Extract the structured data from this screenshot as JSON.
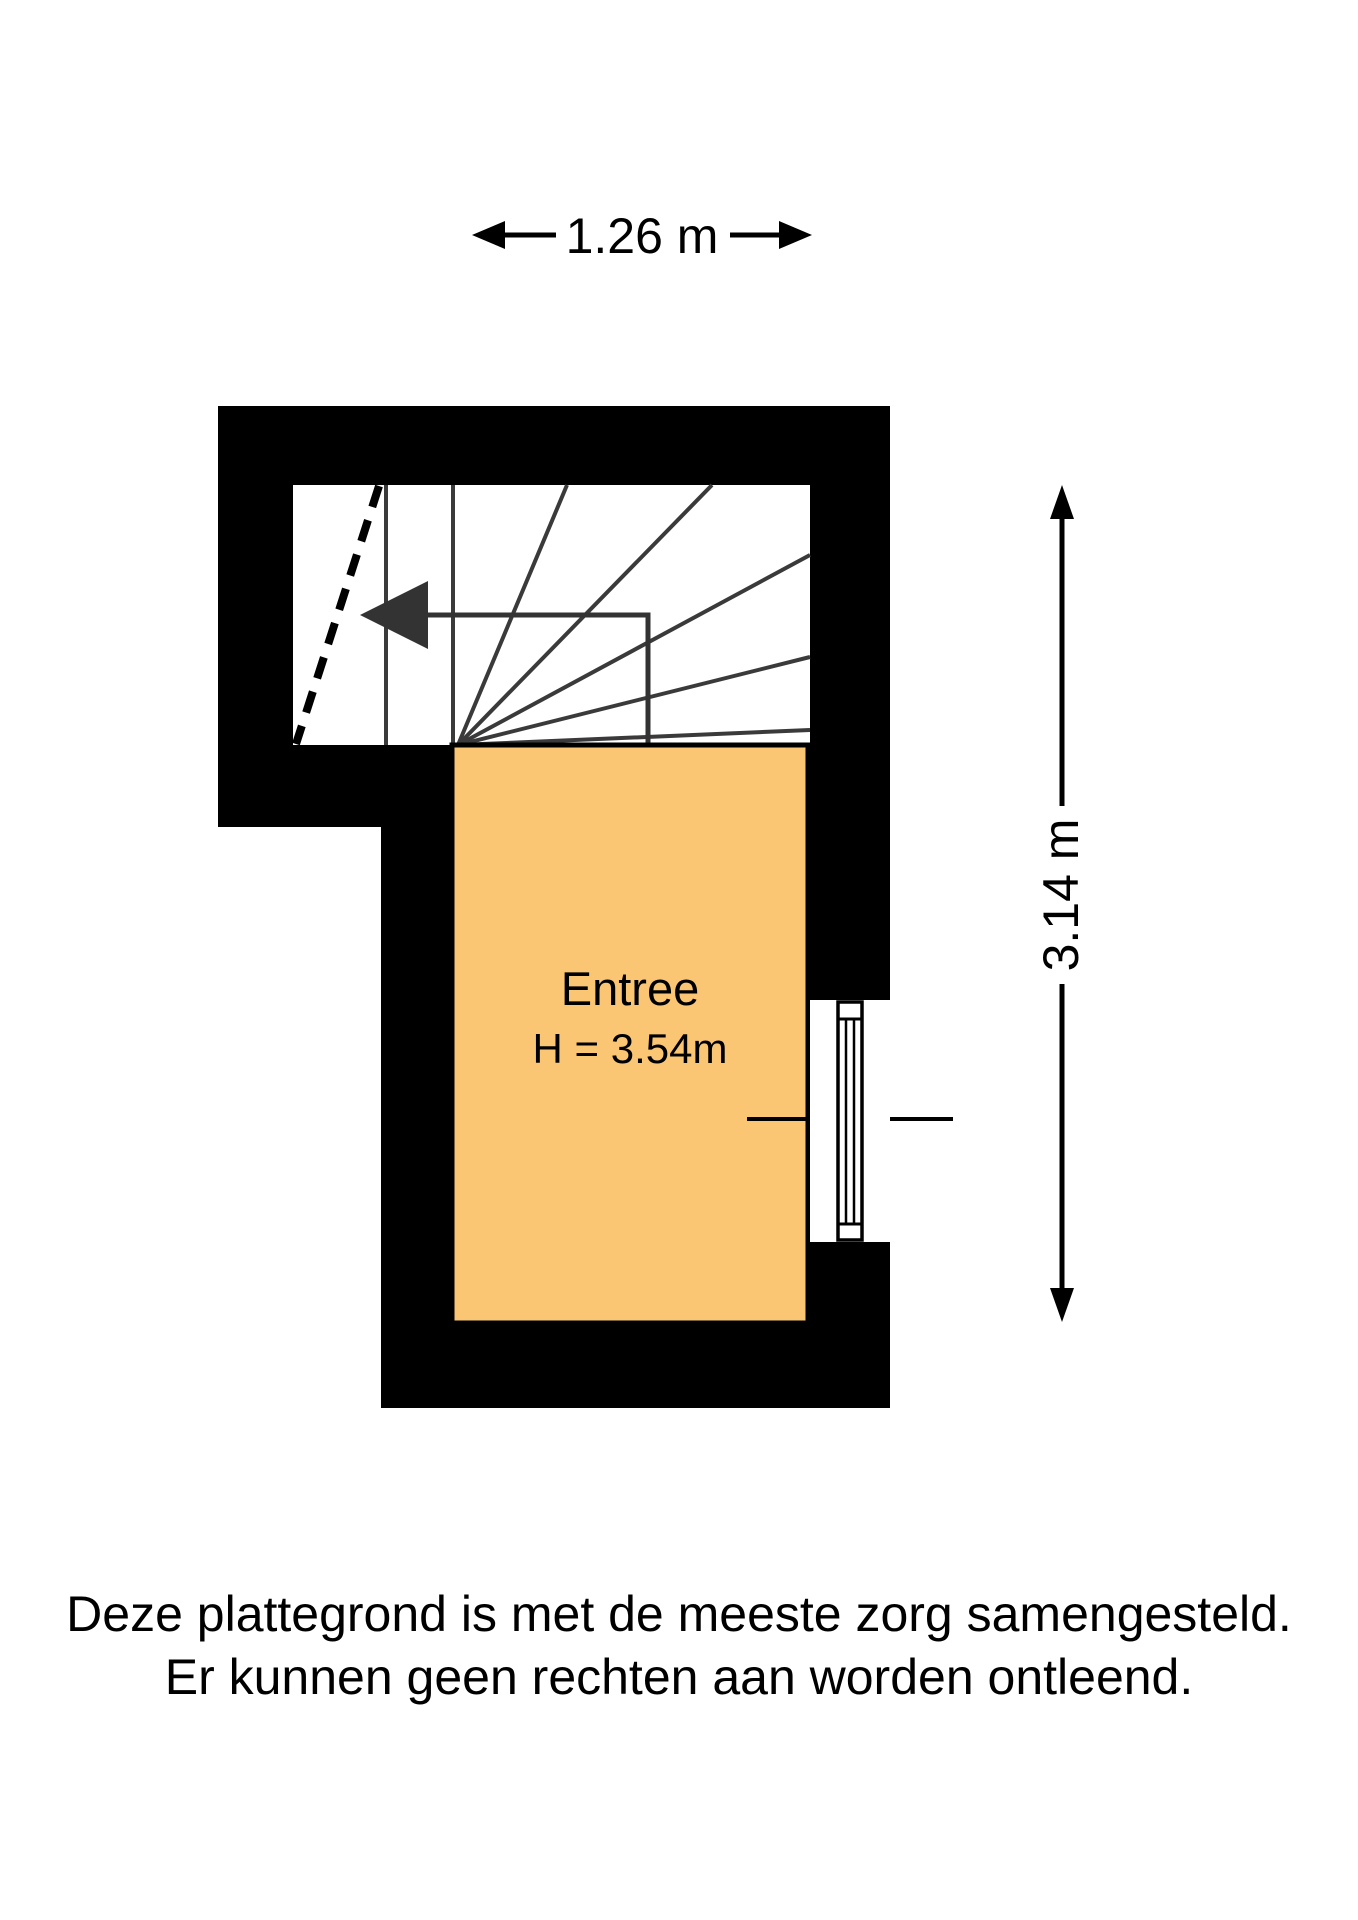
{
  "dimensions": {
    "width": {
      "label": "1.26 m"
    },
    "height": {
      "label": "3.14 m"
    }
  },
  "room": {
    "name": "Entree",
    "ceiling_height": "H = 3.54m"
  },
  "disclaimer": {
    "line1": "Deze plattegrond is met de meeste zorg samengesteld.",
    "line2": "Er kunnen geen rechten aan worden ontleend."
  },
  "colors": {
    "room_fill": "#FAC673",
    "wall": "#000000",
    "stair_line": "#3A3A3A",
    "arrow": "#333333"
  }
}
